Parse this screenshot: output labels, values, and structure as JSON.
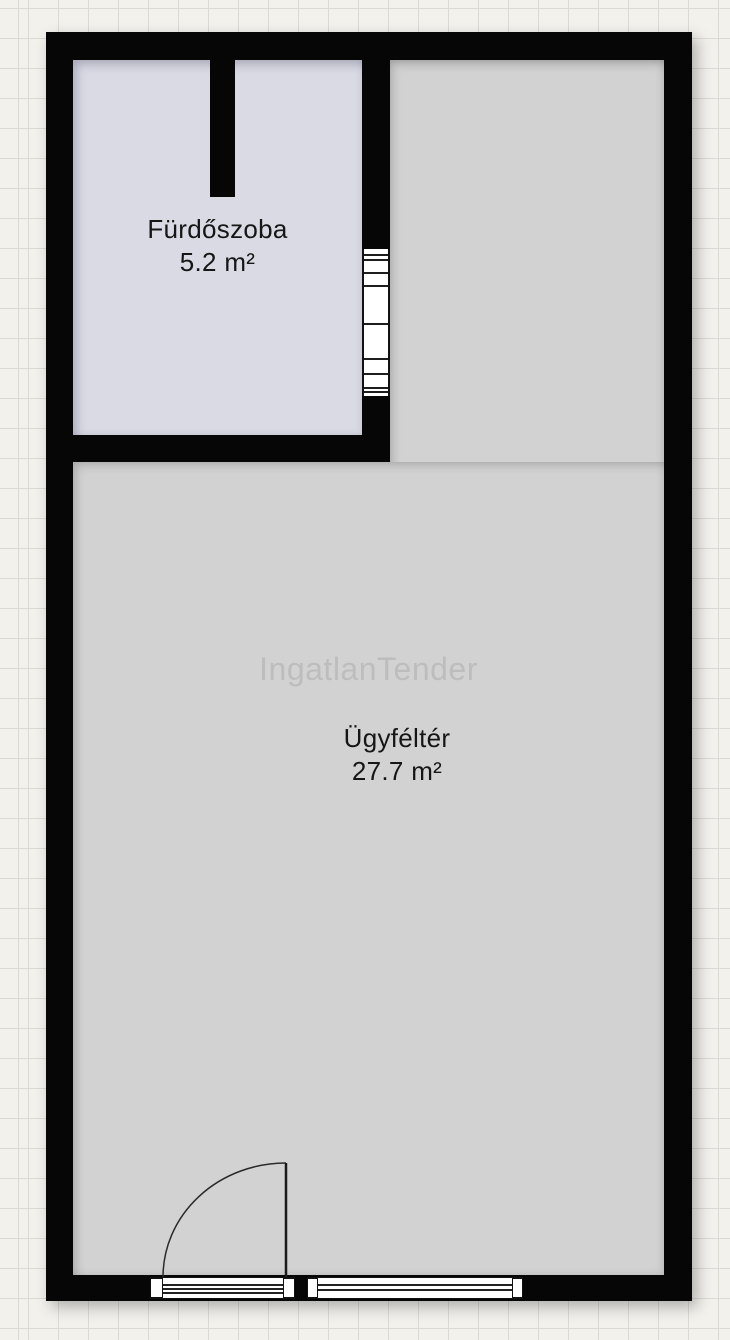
{
  "plan": {
    "watermark": "IngatlanTender",
    "rooms": {
      "bathroom": {
        "name": "Fürdőszoba",
        "area": "5.2 m²"
      },
      "main": {
        "name": "Ügyféltér",
        "area": "27.7 m²"
      }
    },
    "colors": {
      "wall": "#060606",
      "bathroom_fill": "#d9dae3",
      "main_room_fill": "#d2d2d2",
      "paper": "#f2f1ec",
      "grid_line": "#dbdad4",
      "watermark_text": "#c4c4c4",
      "label_text": "#161616"
    }
  }
}
